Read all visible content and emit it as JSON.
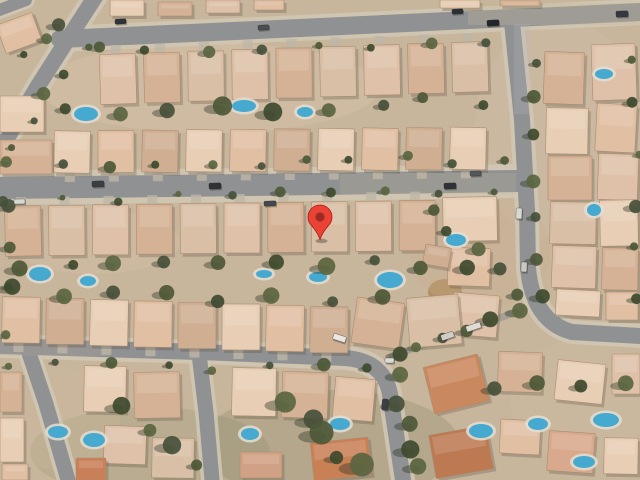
{
  "app": {
    "type": "map-canvas",
    "view_mode": "satellite"
  },
  "marker": {
    "x": 320,
    "y": 239.5,
    "fill": "#EA4335",
    "border": "#B31412",
    "dot": "#9C2B22"
  },
  "scene": {
    "bg": "#c7b59c",
    "road_color": "#8f9193",
    "sidewalk_color": "#cfc6b4",
    "alley_color": "#a5a093",
    "roads": [
      {
        "name": "top-road",
        "d": "M60,39 L300,28 L640,12",
        "w": 18,
        "sw": 26
      },
      {
        "name": "diagonal-road",
        "d": "M97,-6 L75,28 L38,86 L0,150",
        "w": 16,
        "sw": 24
      },
      {
        "name": "corner-stub-road",
        "d": "M-6,12 L26,0",
        "w": 12,
        "sw": 18
      },
      {
        "name": "middle-road",
        "d": "M0,188 L250,185 L516,181",
        "w": 22,
        "sw": 34
      },
      {
        "name": "right-curved-road",
        "d": "M512,22 L522,120 L527,210 L528,268 Q533,322 572,332 L640,336",
        "w": 16,
        "sw": 24
      },
      {
        "name": "bottom-road",
        "d": "M0,346 L200,352 L345,358 Q384,361 390,394 L403,480",
        "w": 16,
        "sw": 24
      },
      {
        "name": "left-vertical-road",
        "d": "M28,350 L46,404 L68,480",
        "w": 15,
        "sw": 22
      },
      {
        "name": "second-vertical-road",
        "d": "M199,354 L206,412 L212,480",
        "w": 15,
        "sw": 22
      },
      {
        "name": "alley-lane",
        "d": "M392,356 L522,310",
        "w": 7,
        "sw": 0
      }
    ],
    "road_patches": [
      [
        340,
        173,
        176,
        21,
        "#c9b69a",
        0.22
      ],
      [
        468,
        3,
        172,
        22,
        "#c9b69a",
        0.28
      ],
      [
        0,
        337,
        110,
        19,
        "#c9b69a",
        0.15
      ],
      [
        514,
        24,
        16,
        90,
        "#b8b9ba",
        0.25
      ]
    ],
    "terrain": [
      [
        330,
        445,
        130,
        55,
        "#69724e",
        0.2
      ],
      [
        150,
        452,
        120,
        45,
        "#6e7652",
        0.15
      ],
      [
        445,
        292,
        17,
        13,
        "#ad8757",
        0.85
      ],
      [
        560,
        130,
        85,
        110,
        "#cfbda6",
        0.45
      ],
      [
        210,
        88,
        170,
        45,
        "#dac5ad",
        0.4
      ],
      [
        95,
        242,
        85,
        32,
        "#d6c1a9",
        0.35
      ],
      [
        480,
        250,
        70,
        60,
        "#c9b193",
        0.3
      ],
      [
        580,
        400,
        70,
        60,
        "#d2bca2",
        0.35
      ],
      [
        60,
        420,
        60,
        50,
        "#cdb89e",
        0.3
      ]
    ],
    "house_palette": [
      "#dec1a8",
      "#e7ceb5",
      "#d5b295",
      "#e0bfa3",
      "#d9bfa6",
      "#cfae92"
    ],
    "house_rows": [
      {
        "n": 9,
        "x0": 100,
        "dx": 44,
        "y0": 54,
        "dy": -1.5,
        "w": 36,
        "h": 50,
        "rot": -1,
        "drive": "up"
      },
      {
        "n": 10,
        "x0": 54,
        "dx": 44,
        "y0": 131,
        "dy": -0.4,
        "w": 36,
        "h": 42,
        "rot": 0.5,
        "drive": "down"
      },
      {
        "n": 10,
        "x0": 5,
        "dx": 43.8,
        "y0": 206,
        "dy": -0.6,
        "w": 36,
        "h": 50,
        "rot": -0.5,
        "drive": "up"
      },
      {
        "n": 8,
        "x0": 2,
        "dx": 44,
        "y0": 297,
        "dy": 1.4,
        "w": 38,
        "h": 46,
        "rot": 0.8,
        "drive": "down"
      }
    ],
    "houses": [
      [
        110,
        0,
        34,
        16,
        0,
        1
      ],
      [
        158,
        2,
        34,
        14,
        0,
        2
      ],
      [
        206,
        0,
        34,
        13,
        0,
        0
      ],
      [
        254,
        0,
        30,
        10,
        0,
        3
      ],
      [
        440,
        0,
        40,
        8,
        0,
        1
      ],
      [
        500,
        0,
        40,
        6,
        0,
        2
      ],
      [
        0,
        18,
        38,
        30,
        -20,
        3
      ],
      [
        0,
        96,
        44,
        36,
        0,
        1
      ],
      [
        0,
        140,
        52,
        34,
        0,
        2
      ],
      [
        443,
        197,
        54,
        44,
        -1,
        1
      ],
      [
        448,
        248,
        42,
        38,
        2,
        3
      ],
      [
        452,
        294,
        46,
        42,
        5,
        0
      ],
      [
        354,
        300,
        48,
        46,
        8,
        2
      ],
      [
        408,
        296,
        52,
        50,
        -5,
        4
      ],
      [
        424,
        246,
        26,
        20,
        10,
        5
      ],
      [
        544,
        52,
        40,
        52,
        2,
        2
      ],
      [
        592,
        44,
        44,
        56,
        -2,
        0
      ],
      [
        546,
        108,
        42,
        46,
        1,
        1
      ],
      [
        596,
        104,
        40,
        48,
        3,
        3
      ],
      [
        548,
        156,
        44,
        44,
        0,
        2
      ],
      [
        598,
        154,
        40,
        46,
        2,
        0
      ],
      [
        550,
        202,
        46,
        42,
        1,
        4
      ],
      [
        600,
        200,
        38,
        46,
        -1,
        1
      ],
      [
        552,
        246,
        44,
        42,
        2,
        0
      ],
      [
        602,
        248,
        36,
        42,
        1,
        2
      ],
      [
        556,
        290,
        44,
        26,
        3,
        1
      ],
      [
        606,
        292,
        32,
        28,
        0,
        3
      ],
      [
        428,
        360,
        56,
        48,
        -14,
        "#c9885e"
      ],
      [
        498,
        352,
        44,
        40,
        2,
        2
      ],
      [
        556,
        362,
        48,
        40,
        6,
        1
      ],
      [
        612,
        354,
        28,
        40,
        0,
        0
      ],
      [
        432,
        430,
        58,
        44,
        -10,
        "#bd7a52"
      ],
      [
        500,
        420,
        40,
        34,
        3,
        3
      ],
      [
        548,
        432,
        46,
        40,
        4,
        "#d8a98c"
      ],
      [
        604,
        438,
        34,
        36,
        1,
        1
      ],
      [
        0,
        372,
        22,
        40,
        0,
        2
      ],
      [
        0,
        418,
        24,
        44,
        0,
        1
      ],
      [
        2,
        464,
        26,
        16,
        0,
        3
      ],
      [
        84,
        366,
        42,
        46,
        1,
        1
      ],
      [
        134,
        372,
        46,
        46,
        -1,
        2
      ],
      [
        104,
        426,
        42,
        38,
        2,
        0
      ],
      [
        152,
        438,
        42,
        40,
        1,
        4
      ],
      [
        76,
        458,
        30,
        22,
        0,
        "#c97f58"
      ],
      [
        232,
        368,
        44,
        48,
        1,
        1
      ],
      [
        282,
        372,
        46,
        46,
        2,
        2
      ],
      [
        334,
        378,
        40,
        42,
        5,
        3
      ],
      [
        240,
        452,
        42,
        26,
        0,
        "#d0a184"
      ],
      [
        312,
        440,
        58,
        38,
        -6,
        "#c98055"
      ]
    ],
    "pools": [
      [
        86,
        114,
        12,
        7
      ],
      [
        244,
        106,
        12,
        6
      ],
      [
        305,
        112,
        8,
        5
      ],
      [
        604,
        74,
        9,
        5
      ],
      [
        40,
        274,
        11,
        7
      ],
      [
        88,
        281,
        8,
        5
      ],
      [
        264,
        274,
        8,
        4
      ],
      [
        318,
        277,
        9,
        5
      ],
      [
        390,
        280,
        13,
        8
      ],
      [
        456,
        240,
        10,
        6
      ],
      [
        594,
        210,
        7,
        6
      ],
      [
        58,
        432,
        10,
        6
      ],
      [
        94,
        440,
        11,
        7
      ],
      [
        250,
        434,
        9,
        6
      ],
      [
        340,
        424,
        10,
        6
      ],
      [
        481,
        431,
        12,
        7
      ],
      [
        538,
        424,
        10,
        6
      ],
      [
        606,
        420,
        13,
        7
      ],
      [
        584,
        462,
        11,
        6
      ]
    ],
    "pool_color": "#46a9cf",
    "deck_color": "#e3ded2",
    "tree_palette": [
      "#4d5837",
      "#3e4a2e",
      "#5a6540",
      "#46503a"
    ],
    "tree_lines": [
      [
        95,
        52,
        480,
        40,
        8,
        5
      ],
      [
        70,
        112,
        480,
        100,
        9,
        7
      ],
      [
        10,
        166,
        500,
        160,
        11,
        5
      ],
      [
        8,
        200,
        500,
        194,
        10,
        4
      ],
      [
        20,
        268,
        470,
        262,
        10,
        7
      ],
      [
        10,
        292,
        380,
        300,
        8,
        6
      ],
      [
        10,
        362,
        370,
        372,
        8,
        5
      ],
      [
        536,
        60,
        540,
        300,
        7,
        6
      ],
      [
        634,
        60,
        637,
        300,
        6,
        5
      ],
      [
        398,
        352,
        520,
        312,
        6,
        7
      ],
      [
        398,
        380,
        418,
        470,
        5,
        8
      ],
      [
        500,
        388,
        630,
        388,
        4,
        7
      ],
      [
        85,
        45,
        15,
        150,
        5,
        5
      ],
      [
        120,
        408,
        200,
        470,
        4,
        7
      ],
      [
        290,
        400,
        360,
        470,
        5,
        9
      ],
      [
        4,
        210,
        6,
        330,
        4,
        5
      ],
      [
        430,
        210,
        520,
        290,
        5,
        6
      ],
      [
        30,
        60,
        60,
        20,
        3,
        5
      ]
    ],
    "cars": [
      [
        92,
        181,
        12,
        6,
        -2,
        "#3a3f45"
      ],
      [
        209,
        183,
        12,
        6,
        -2,
        "#2e3338"
      ],
      [
        264,
        201,
        12,
        5,
        -2,
        "#44474c"
      ],
      [
        14,
        199,
        11,
        5,
        -1,
        "#d8d8d2"
      ],
      [
        444,
        183,
        12,
        6,
        -2,
        "#2f3338"
      ],
      [
        470,
        171,
        11,
        5,
        -2,
        "#53565a"
      ],
      [
        115,
        19,
        11,
        5,
        -3,
        "#303438"
      ],
      [
        258,
        25,
        11,
        5,
        -3,
        "#4a4e52"
      ],
      [
        452,
        9,
        11,
        5,
        -3,
        "#2c3034"
      ],
      [
        487,
        20,
        12,
        6,
        -3,
        "#232629"
      ],
      [
        616,
        11,
        12,
        6,
        -2,
        "#35383c"
      ],
      [
        333,
        335,
        13,
        6,
        18,
        "#e8e7e2"
      ],
      [
        382,
        399,
        6,
        11,
        5,
        "#3c4044"
      ],
      [
        385,
        358,
        9,
        5,
        0,
        "#dcdcd6"
      ],
      [
        516,
        208,
        6,
        11,
        2,
        "#d9d9d3"
      ],
      [
        521,
        262,
        6,
        10,
        2,
        "#c9c9c3"
      ],
      [
        466,
        324,
        15,
        6,
        -19,
        "#dedcd4"
      ],
      [
        441,
        333,
        13,
        6,
        -19,
        "#cfcdc5"
      ]
    ]
  }
}
